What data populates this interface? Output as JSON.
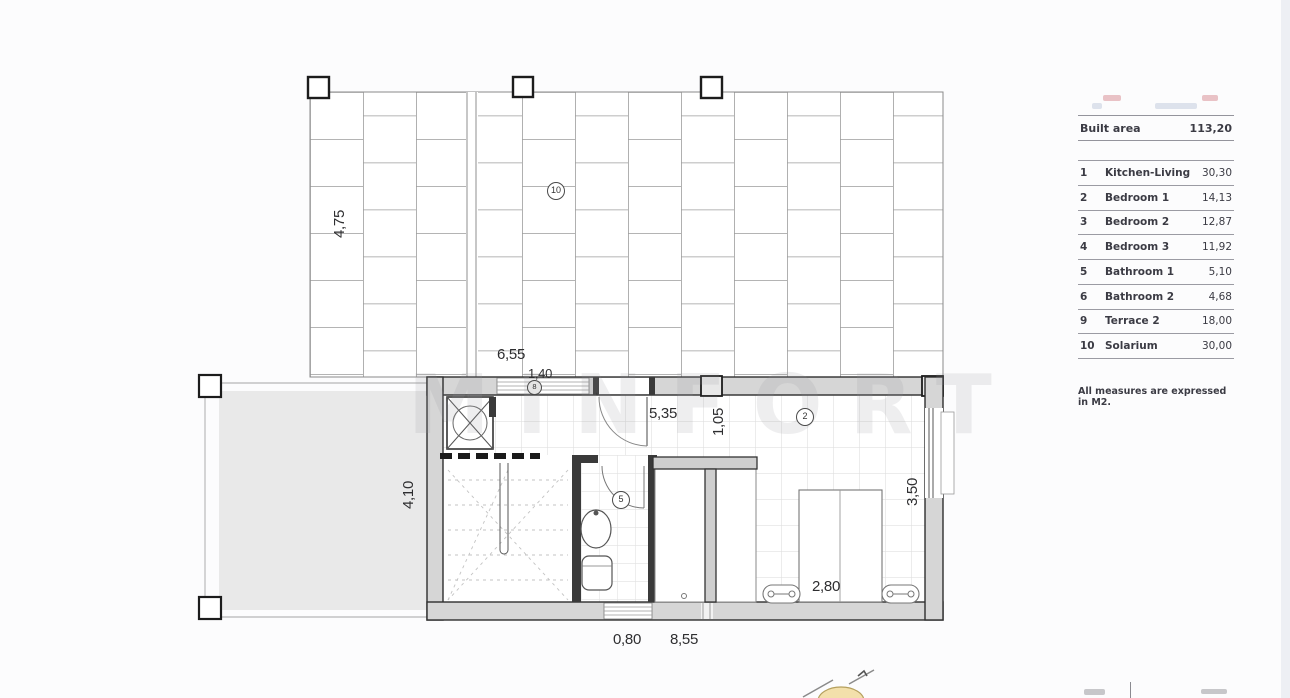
{
  "legend": {
    "built": {
      "label": "Built area",
      "value": "113,20"
    },
    "rows": [
      {
        "num": "1",
        "name": "Kitchen-Living",
        "value": "30,30"
      },
      {
        "num": "2",
        "name": "Bedroom 1",
        "value": "14,13"
      },
      {
        "num": "3",
        "name": "Bedroom 2",
        "value": "12,87"
      },
      {
        "num": "4",
        "name": "Bedroom 3",
        "value": "11,92"
      },
      {
        "num": "5",
        "name": "Bathroom 1",
        "value": "5,10"
      },
      {
        "num": "6",
        "name": "Bathroom 2",
        "value": "4,68"
      },
      {
        "num": "9",
        "name": "Terrace 2",
        "value": "18,00"
      },
      {
        "num": "10",
        "name": "Solarium",
        "value": "30,00"
      }
    ],
    "note": "All measures are expressed in M2."
  },
  "plan": {
    "dims": {
      "roof_height": "4,75",
      "roof_width": "6,55",
      "opening_width": "1,40",
      "hall_length": "5,35",
      "wall_length": "1,05",
      "terrace_height": "4,10",
      "bedroom_height": "3,50",
      "bed_width": "2,80",
      "door_width": "0,80",
      "bottom_width": "8,55"
    },
    "markers": {
      "solarium": "10",
      "column": "8",
      "bedroom": "2",
      "bathroom": "5"
    }
  },
  "watermark": {
    "text": "MINFORT"
  },
  "colors": {
    "wall_fill": "#d6d6d6",
    "terrace_fill": "#e9e9e9",
    "logo_sun": "#f3e0ab",
    "accent_pink": "#e9c2c6"
  }
}
